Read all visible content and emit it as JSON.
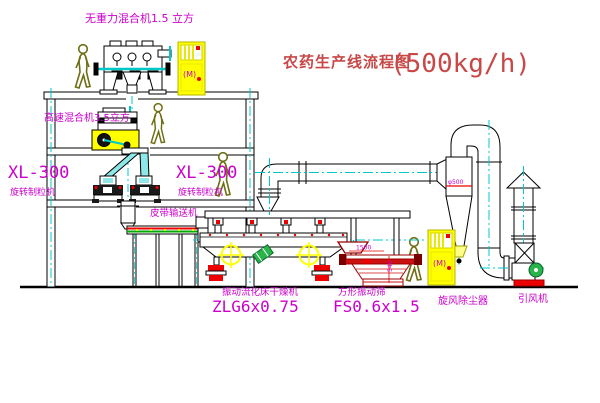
{
  "title": {
    "main": "农药生产线流程图",
    "capacity": "(500kg/h)"
  },
  "equipment": {
    "gravity_mixer": {
      "label": "无重力混合机1.5 立方"
    },
    "high_speed_mixer": {
      "label": "高速混合机3.5立方"
    },
    "granulator_left": {
      "model": "XL-300",
      "name": "旋转制粒机"
    },
    "granulator_right": {
      "model": "XL-300",
      "name": "旋转制粒机"
    },
    "belt_conveyor": {
      "name": "皮带输送机"
    },
    "dryer": {
      "name": "振动流化床干燥机",
      "model": "ZLG6x0.75"
    },
    "screen": {
      "name": "方形振动筛",
      "model": "FS0.6x1.5",
      "dim_width": "1500",
      "dim_height": "540"
    },
    "cyclone": {
      "name": "旋风除尘器",
      "dim": "φ500"
    },
    "fan": {
      "name": "引风机"
    },
    "cabinet_top": {
      "marking": "(M)"
    },
    "cabinet_bottom": {
      "marking": "(M)"
    }
  },
  "colors": {
    "label_magenta": "#cc00cc",
    "title_red": "#c84848",
    "centerline_cyan": "#00c8c8",
    "cabinet_yellow": "#ffff00",
    "person_olive": "#6e6e14",
    "screen_dark_red": "#990000",
    "accent_red": "#ee0000",
    "machine_green": "#2ab54a"
  }
}
